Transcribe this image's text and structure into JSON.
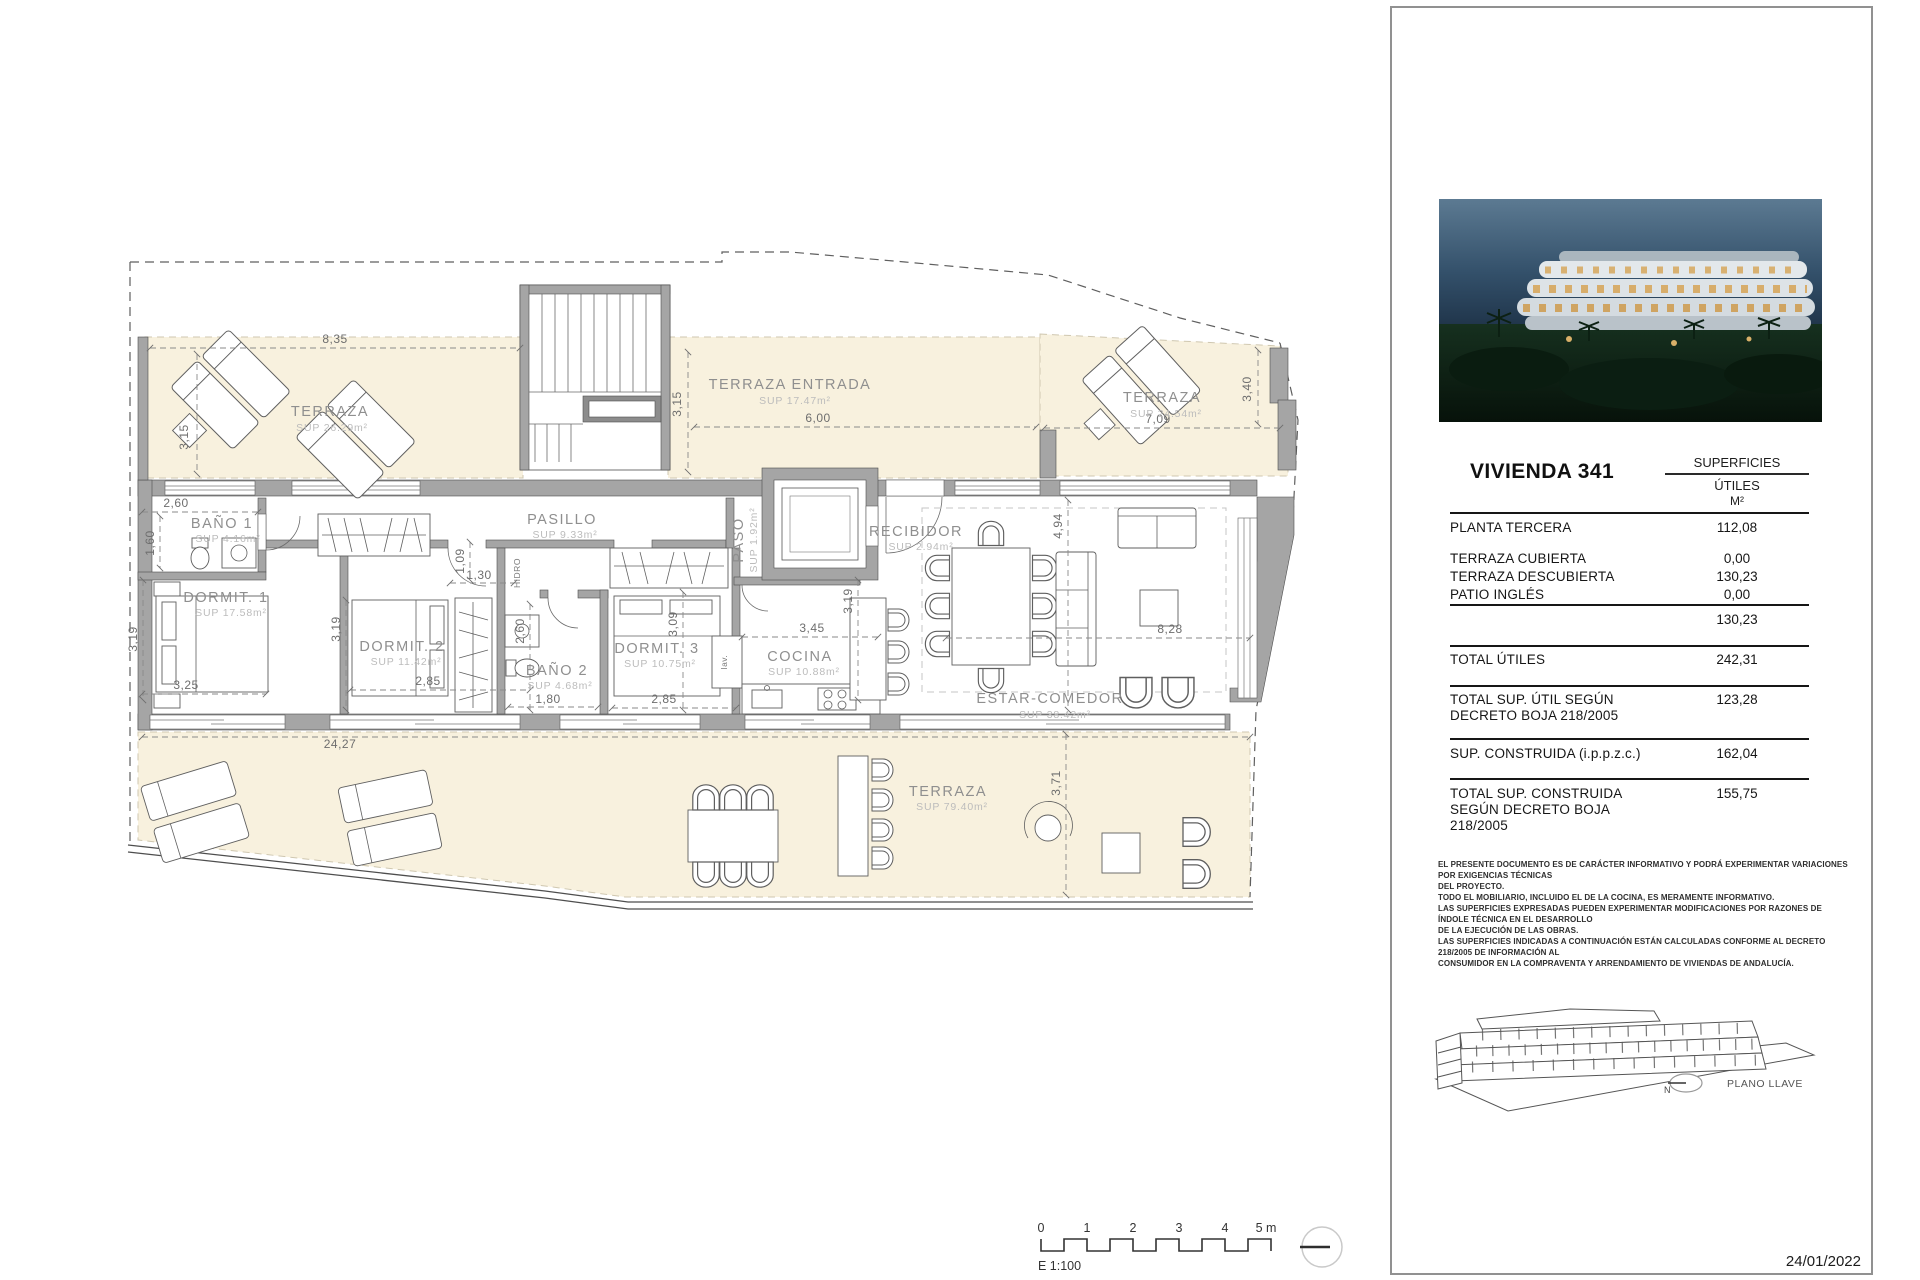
{
  "document": {
    "date": "24/01/2022"
  },
  "panel": {
    "title": "VIVIENDA 341",
    "table": {
      "header": {
        "group": "SUPERFICIES",
        "col": "ÚTILES",
        "unit": "M²"
      },
      "rows": [
        {
          "label": "PLANTA TERCERA",
          "value": "112,08"
        },
        {
          "label": "TERRAZA CUBIERTA",
          "value": "0,00"
        },
        {
          "label": "TERRAZA DESCUBIERTA",
          "value": "130,23"
        },
        {
          "label": "PATIO INGLÉS",
          "value": "0,00"
        },
        {
          "label": "",
          "value": "130,23"
        },
        {
          "label": "TOTAL ÚTILES",
          "value": "242,31"
        },
        {
          "label": "TOTAL SUP. ÚTIL SEGÚN DECRETO BOJA 218/2005",
          "value": "123,28"
        },
        {
          "label": "SUP. CONSTRUIDA (i.p.p.z.c.)",
          "value": "162,04"
        },
        {
          "label": "TOTAL SUP. CONSTRUIDA SEGÚN DECRETO BOJA 218/2005",
          "value": "155,75"
        }
      ]
    },
    "disclaimer": [
      "EL PRESENTE DOCUMENTO ES DE CARÁCTER INFORMATIVO Y PODRÁ EXPERIMENTAR VARIACIONES POR EXIGENCIAS TÉCNICAS",
      "DEL PROYECTO.",
      "TODO EL MOBILIARIO, INCLUIDO EL DE LA COCINA, ES MERAMENTE INFORMATIVO.",
      "LAS SUPERFICIES EXPRESADAS PUEDEN EXPERIMENTAR MODIFICACIONES POR RAZONES DE ÍNDOLE TÉCNICA EN EL DESARROLLO",
      "DE LA EJECUCIÓN DE LAS OBRAS.",
      "LAS SUPERFICIES INDICADAS A CONTINUACIÓN ESTÁN CALCULADAS CONFORME AL DECRETO 218/2005 DE INFORMACIÓN AL",
      "CONSUMIDOR EN LA COMPRAVENTA Y ARRENDAMIENTO DE VIVIENDAS DE ANDALUCÍA."
    ],
    "key_plan": {
      "north": "N",
      "label": "PLANO LLAVE"
    }
  },
  "plan": {
    "rooms": [
      {
        "name": "TERRAZA",
        "sup": "SUP 26.29m²"
      },
      {
        "name": "TERRAZA ENTRADA",
        "sup": "SUP 17.47m²"
      },
      {
        "name": "TERRAZA",
        "sup": "SUP 24.54m²"
      },
      {
        "name": "BAÑO 1",
        "sup": "SUP 4.16m²"
      },
      {
        "name": "DORMIT. 1",
        "sup": "SUP 17.58m²"
      },
      {
        "name": "DORMIT. 2",
        "sup": "SUP 11.42m²"
      },
      {
        "name": "BAÑO 2",
        "sup": "SUP 4.68m²"
      },
      {
        "name": "DORMIT. 3",
        "sup": "SUP 10.75m²"
      },
      {
        "name": "PASILLO",
        "sup": "SUP 9.33m²"
      },
      {
        "name": "PASO",
        "sup": "SUP 1.92m²"
      },
      {
        "name": "RECIBIDOR",
        "sup": "SUP 2.94m²"
      },
      {
        "name": "COCINA",
        "sup": "SUP 10.88m²"
      },
      {
        "name": "ESTAR-COMEDOR",
        "sup": "SUP 38.42m²"
      },
      {
        "name": "TERRAZA",
        "sup": "SUP 79.40m²"
      }
    ],
    "dims": [
      "8,35",
      "3,15",
      "3,15",
      "6,00",
      "7,09",
      "3,40",
      "2,60",
      "1,60",
      "3,19",
      "3,25",
      "3,19",
      "2,85",
      "2,60",
      "1,80",
      "2,85",
      "3,09",
      "1,30",
      "1,09",
      "3,45",
      "3,19",
      "4,94",
      "8,28",
      "3,71",
      "24,27"
    ],
    "annotations": {
      "hidro": "HIDRO",
      "lav": "lav."
    }
  },
  "scale_bar": {
    "ticks": [
      "0",
      "1",
      "2",
      "3",
      "4",
      "5 m"
    ],
    "label": "E 1:100"
  }
}
